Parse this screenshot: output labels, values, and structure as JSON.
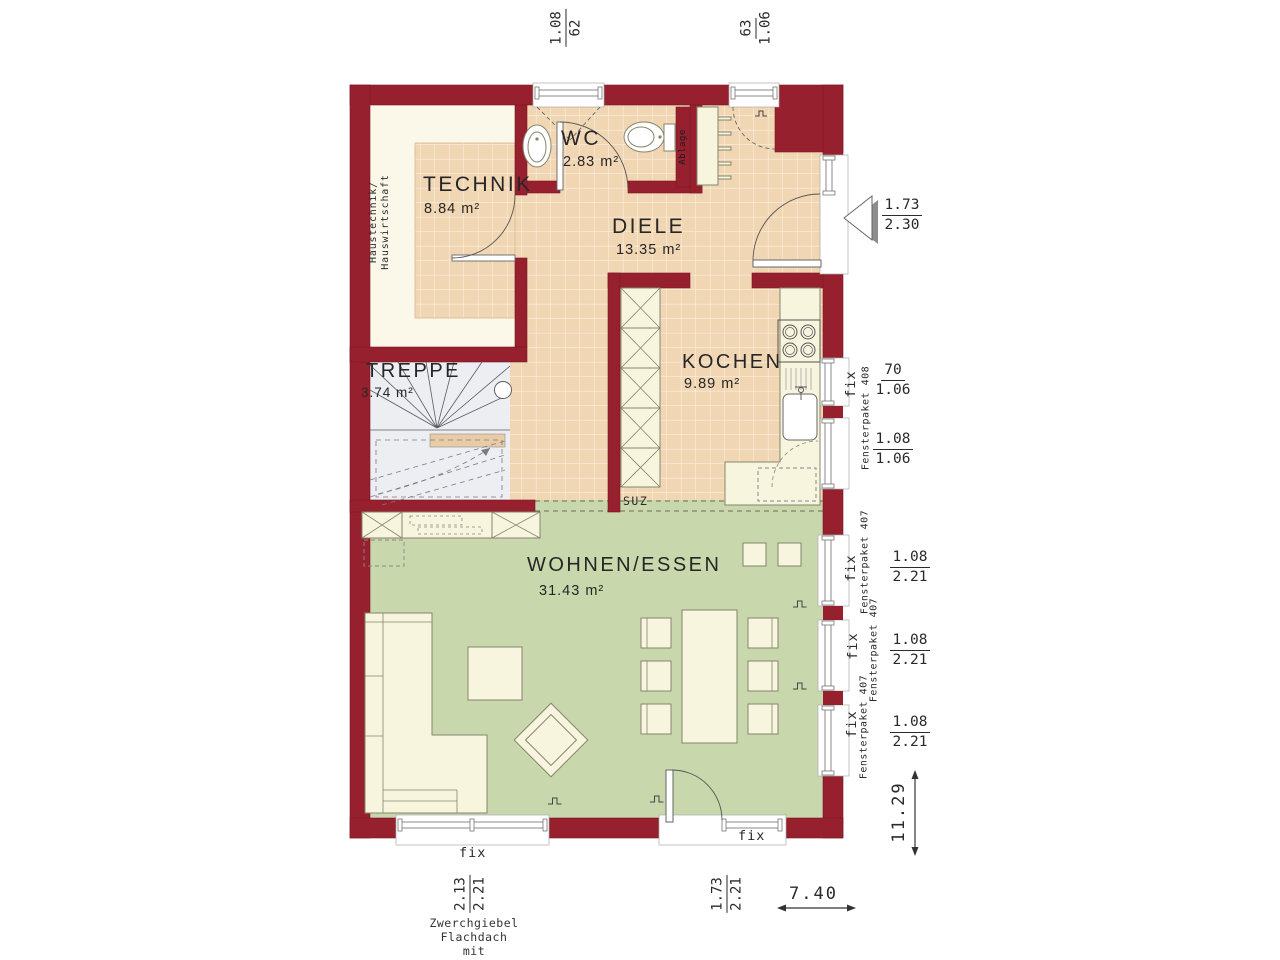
{
  "colors": {
    "wall": "#97202f",
    "tile": "#f1d6b4",
    "tile_line": "#fbeedb",
    "living": "#c9d8ac",
    "cream_room": "#fbf8e9",
    "furniture": "#f8f5df",
    "stairs": "#eceef2"
  },
  "rooms": {
    "technik": {
      "name": "TECHNIK",
      "area": "8.84 m²"
    },
    "wc": {
      "name": "WC",
      "area": "2.83 m²"
    },
    "diele": {
      "name": "DIELE",
      "area": "13.35 m²"
    },
    "treppe": {
      "name": "TREPPE",
      "area": "3.74 m²"
    },
    "kochen": {
      "name": "KOCHEN",
      "area": "9.89 m²"
    },
    "wohnen": {
      "name": "WOHNEN/ESSEN",
      "area": "31.43 m²"
    }
  },
  "annotations": {
    "haustechnik_line1": "Haustechnik/",
    "haustechnik_line2": "Hauswirtschaft",
    "ablage": "Ablage",
    "suz": "SUZ",
    "fix": "fix",
    "fensterpaket_408": "Fensterpaket 408",
    "fensterpaket_407": "Fensterpaket 407"
  },
  "dimensions": {
    "top_window_left": {
      "w": "1.08",
      "h": "62"
    },
    "top_window_right": {
      "w": "63",
      "h": "1.06"
    },
    "entrance_door": {
      "w": "1.73",
      "h": "2.30"
    },
    "kitchen_window_small": {
      "w": "70",
      "h": "1.06"
    },
    "kitchen_window_large": {
      "w": "1.08",
      "h": "1.06"
    },
    "living_window": {
      "w": "1.08",
      "h": "2.21"
    },
    "bottom_window": {
      "w": "2.13",
      "h": "2.21"
    },
    "terrace_door": {
      "w": "1.73",
      "h": "2.21"
    },
    "overall_width": "7.40",
    "overall_depth": "11.29"
  },
  "footnote": {
    "line1": "Zwerchgiebel Flachdach",
    "line2": "mit Fassadenaufdopplung",
    "line3": "Sonderausstattung"
  }
}
